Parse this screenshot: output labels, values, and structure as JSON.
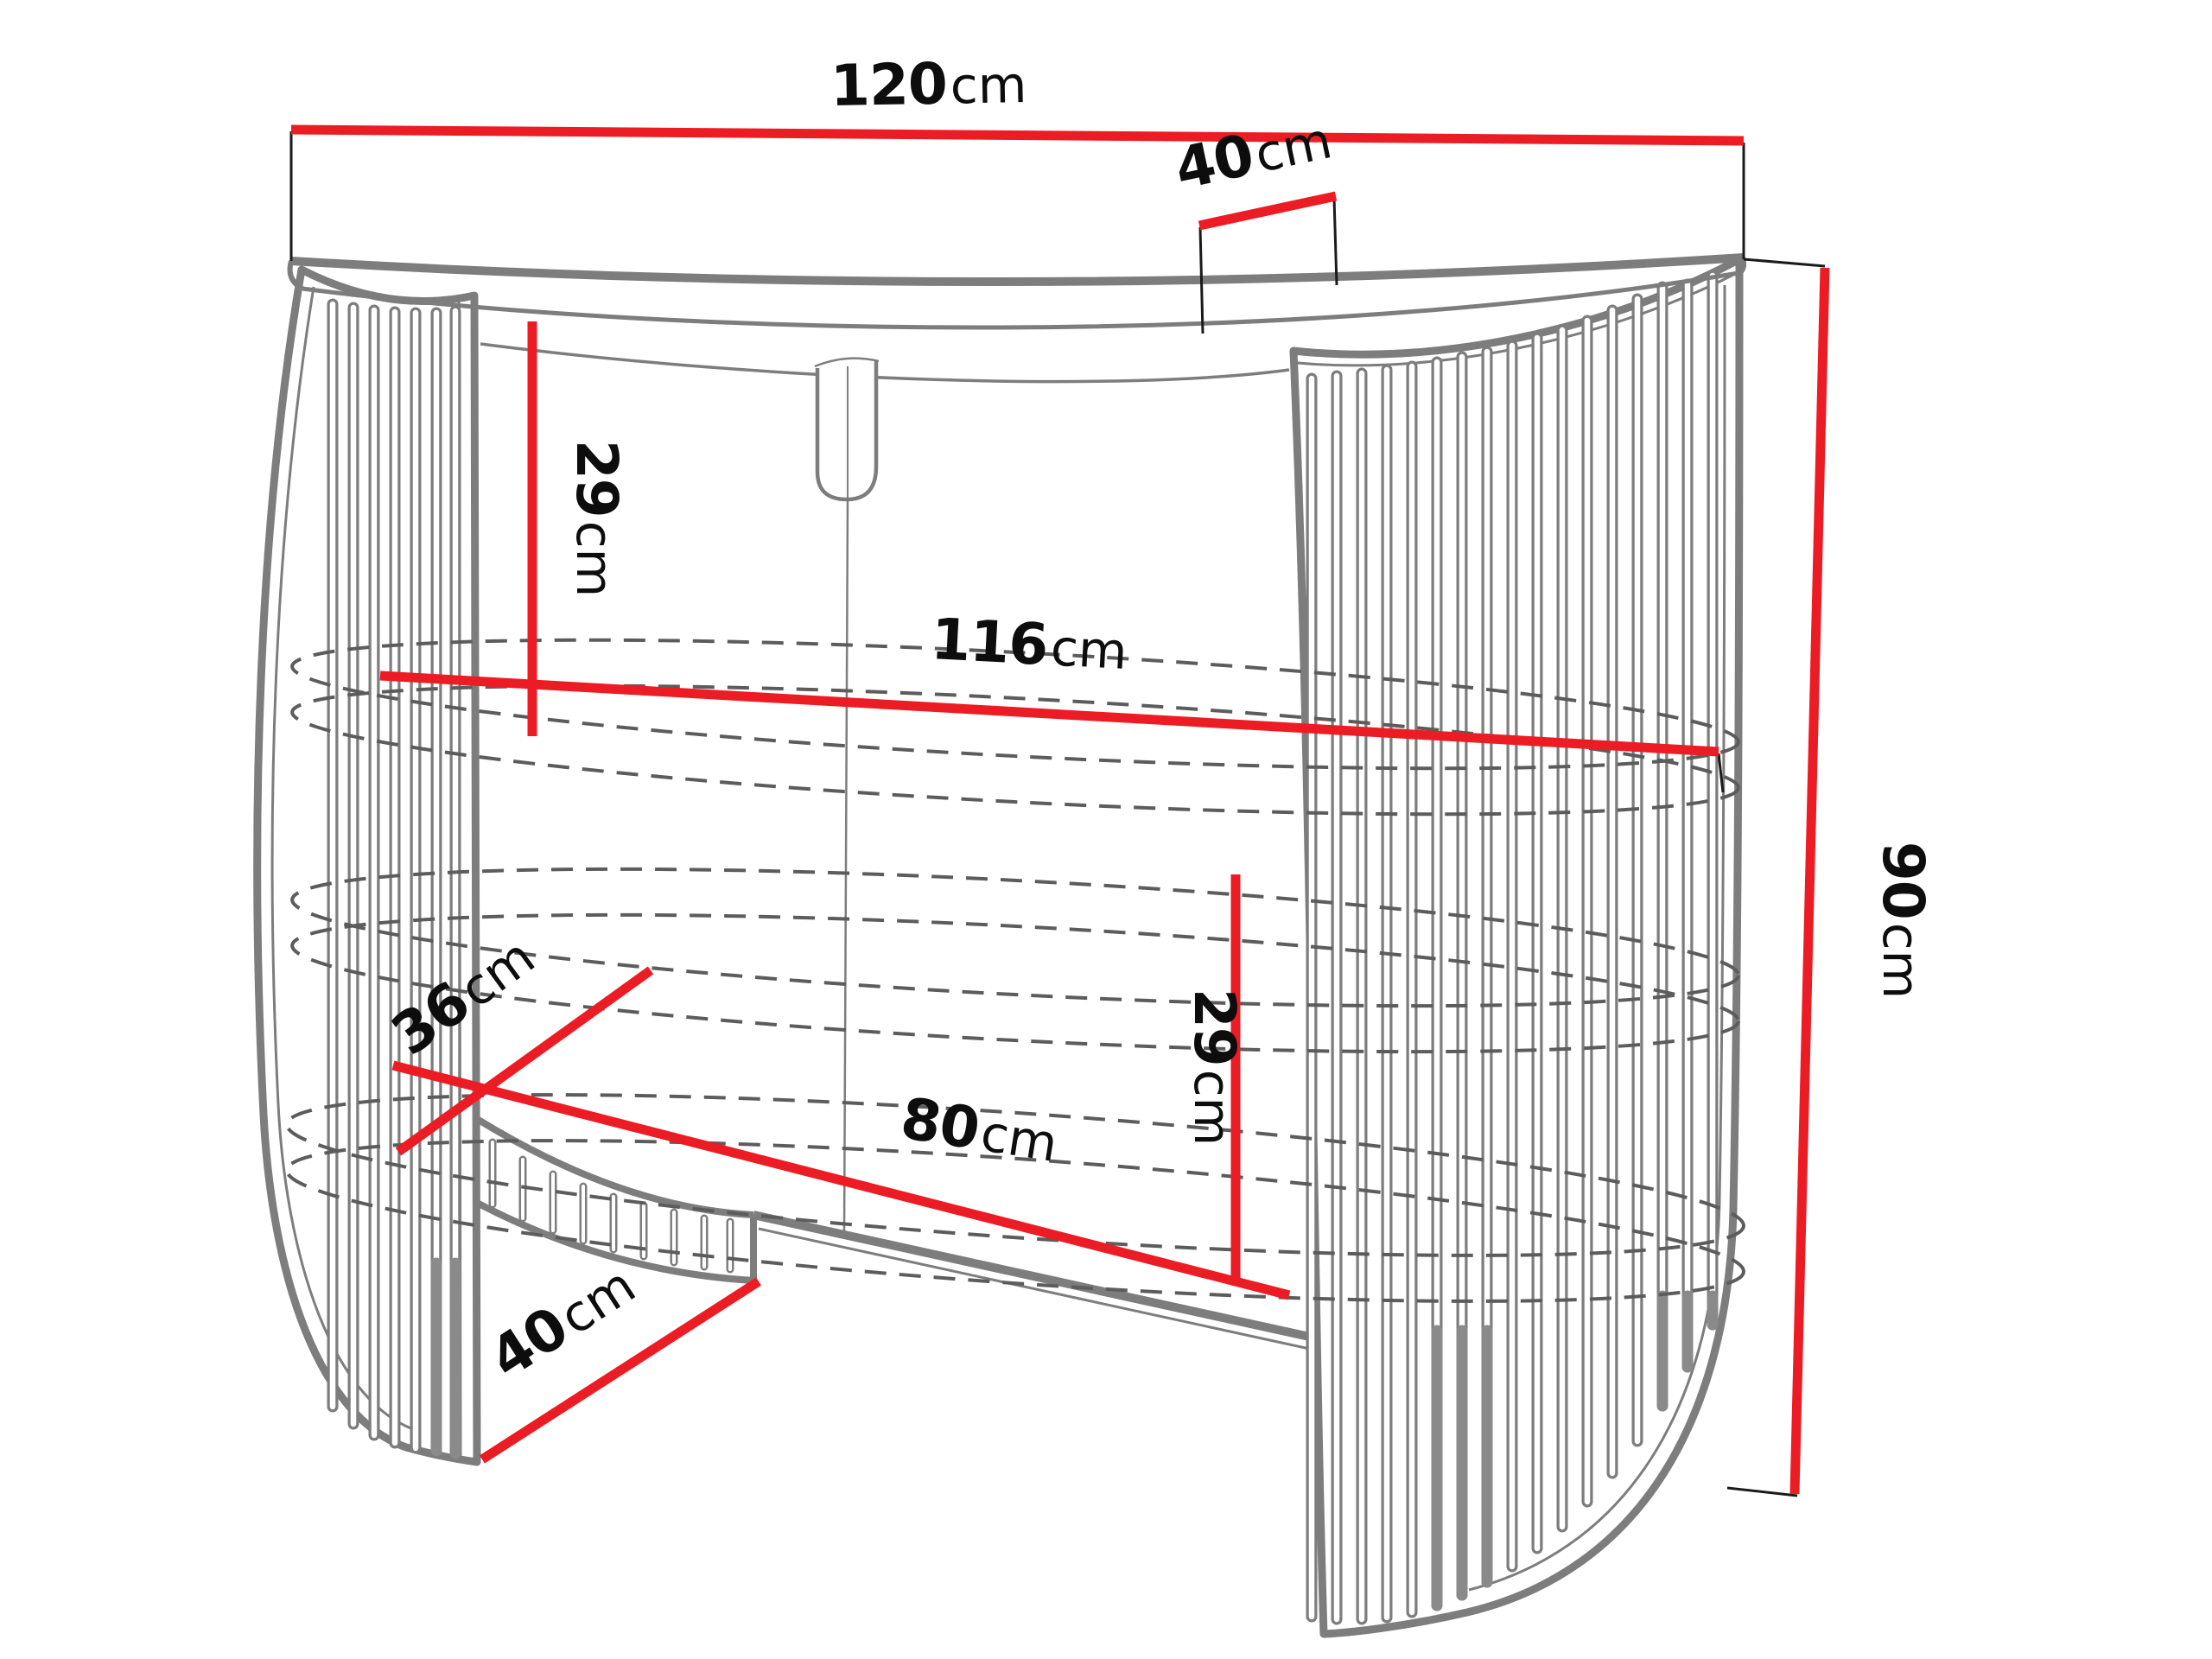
{
  "diagram": {
    "type": "furniture-dimension-drawing",
    "subject": "fluted oval console table with two slatted pedestals and open middle shelf",
    "unit": "cm",
    "colors": {
      "dimension_line": "#ec1c24",
      "furniture_outline": "#7d7d7d",
      "hidden_edge_dashed": "#5c5c5c",
      "label_text": "#0d0d0d",
      "background": "#ffffff"
    },
    "dims": [
      {
        "id": "total-width",
        "value": "120",
        "unit": "cm",
        "label": "120cm"
      },
      {
        "id": "top-depth",
        "value": "40",
        "unit": "cm",
        "label": "40cm"
      },
      {
        "id": "top-to-shelf",
        "value": "29",
        "unit": "cm",
        "label": "29cm"
      },
      {
        "id": "inner-shelf-width",
        "value": "116",
        "unit": "cm",
        "label": "116cm"
      },
      {
        "id": "total-height",
        "value": "90",
        "unit": "cm",
        "label": "90cm"
      },
      {
        "id": "shelf-depth",
        "value": "36",
        "unit": "cm",
        "label": "36cm"
      },
      {
        "id": "opening-width",
        "value": "80",
        "unit": "cm",
        "label": "80cm"
      },
      {
        "id": "shelf-spacing",
        "value": "29",
        "unit": "cm",
        "label": "29cm"
      },
      {
        "id": "base-depth",
        "value": "40",
        "unit": "cm",
        "label": "40cm"
      }
    ]
  }
}
